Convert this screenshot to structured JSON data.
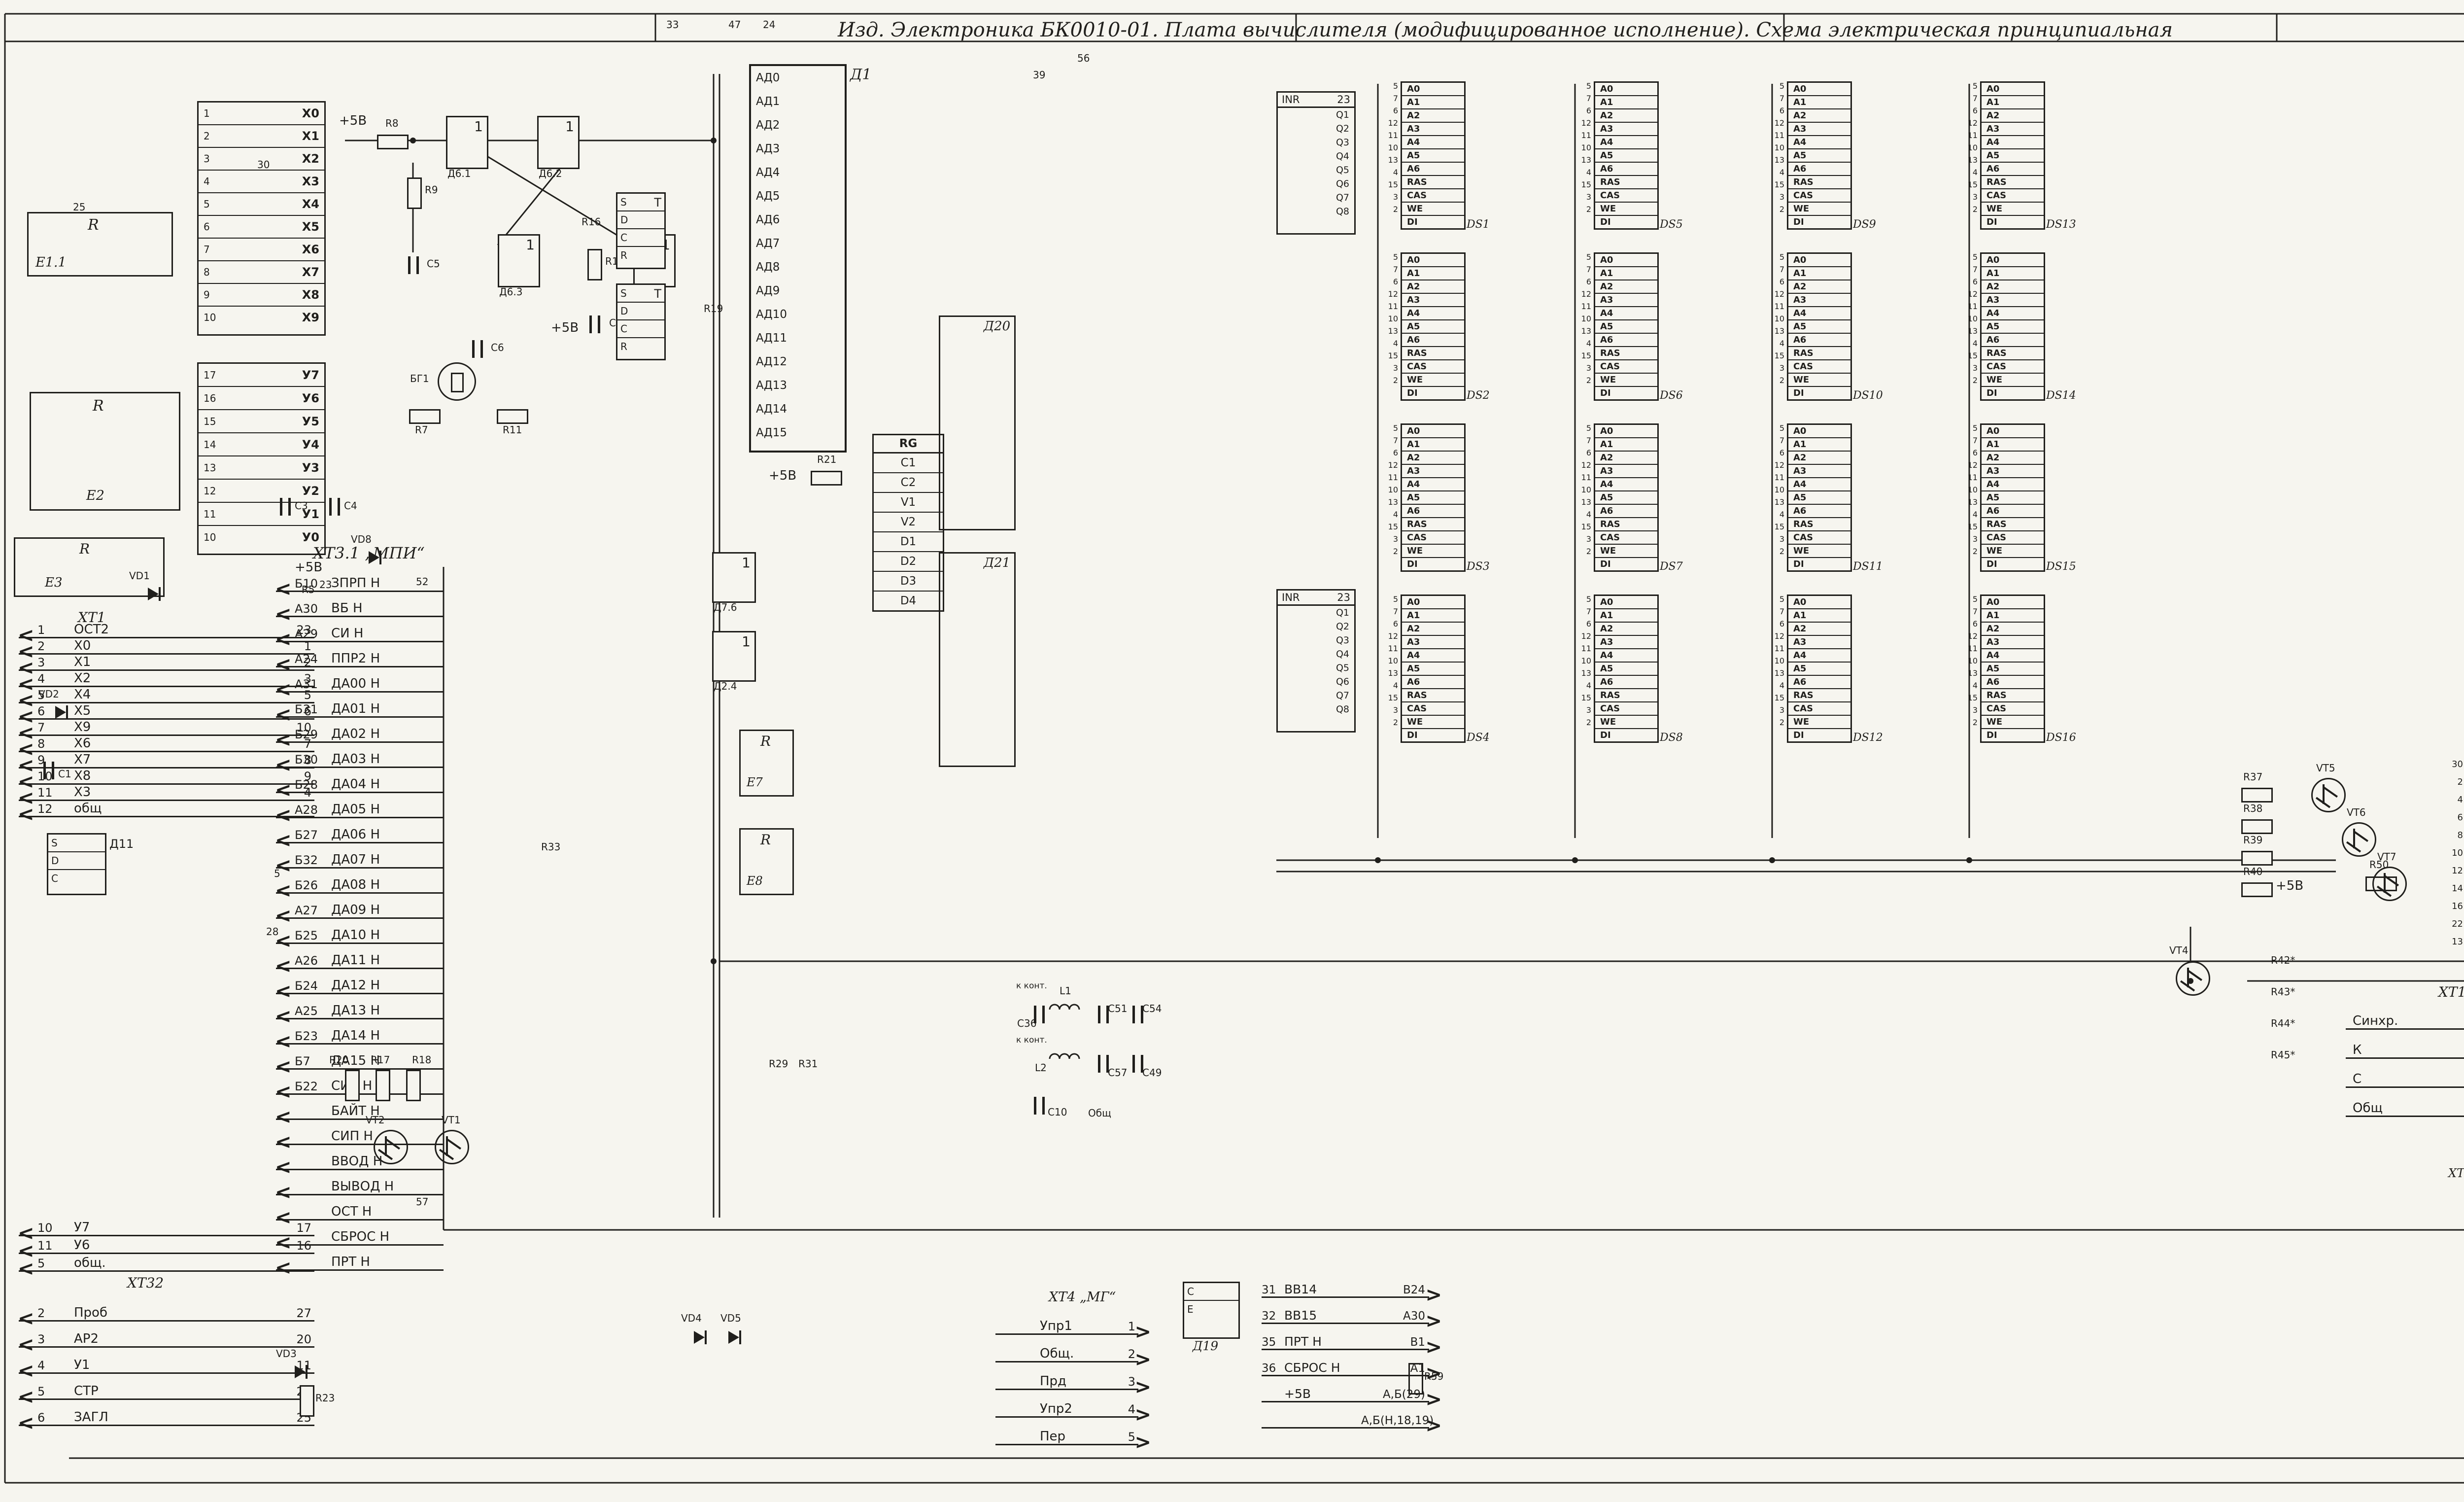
{
  "title": {
    "main": "Изд. Электроника  БК0010-01. Плата вычислителя (модифицированное исполнение). Схема  электрическая  принципиальная",
    "appendix": "Приложение"
  },
  "colors": {
    "ink": "#201f1c",
    "paper": "#f6f5ef"
  },
  "left": {
    "networks": [
      {
        "sym": "R",
        "name": "E1.1"
      },
      {
        "sym": "R",
        "name": "E2"
      },
      {
        "sym": "R",
        "name": "E3"
      }
    ],
    "xt1": {
      "name": "ХТ1",
      "rows": [
        {
          "pin": "1",
          "sig": "ОСТ2",
          "num": "23"
        },
        {
          "pin": "2",
          "sig": "Х0",
          "num": "1"
        },
        {
          "pin": "3",
          "sig": "Х1",
          "num": "2"
        },
        {
          "pin": "4",
          "sig": "Х2",
          "num": "3"
        },
        {
          "pin": "5",
          "sig": "Х4",
          "num": "5"
        },
        {
          "pin": "6",
          "sig": "Х5",
          "num": "6"
        },
        {
          "pin": "7",
          "sig": "Х9",
          "num": "10"
        },
        {
          "pin": "8",
          "sig": "Х6",
          "num": "7"
        },
        {
          "pin": "9",
          "sig": "Х7",
          "num": "8"
        },
        {
          "pin": "10",
          "sig": "Х8",
          "num": "9"
        },
        {
          "pin": "11",
          "sig": "Х3",
          "num": "4"
        },
        {
          "pin": "12",
          "sig": "общ",
          "num": ""
        }
      ]
    },
    "xt1b_rows": [
      {
        "pin": "10",
        "sig": "У7",
        "num": "17"
      },
      {
        "pin": "11",
        "sig": "У6",
        "num": "16"
      },
      {
        "pin": "5",
        "sig": "общ.",
        "num": ""
      }
    ],
    "xt32": {
      "name": "ХТ32",
      "rows": [
        {
          "pin": "2",
          "sig": "Проб",
          "num": "27"
        },
        {
          "pin": "3",
          "sig": "АР2",
          "num": "20"
        },
        {
          "pin": "4",
          "sig": "У1",
          "num": "11"
        },
        {
          "pin": "5",
          "sig": "СТР",
          "num": "26"
        },
        {
          "pin": "6",
          "sig": "ЗАГЛ",
          "num": "25"
        }
      ]
    },
    "d11": {
      "cells": [
        "S",
        "D",
        "C"
      ],
      "ds": "Д11"
    }
  },
  "keyboard": {
    "x_rows": [
      {
        "pin": "1",
        "sig": "Х0"
      },
      {
        "pin": "2",
        "sig": "Х1"
      },
      {
        "pin": "3",
        "sig": "Х2"
      },
      {
        "pin": "4",
        "sig": "Х3"
      },
      {
        "pin": "5",
        "sig": "Х4"
      },
      {
        "pin": "6",
        "sig": "Х5"
      },
      {
        "pin": "7",
        "sig": "Х6"
      },
      {
        "pin": "8",
        "sig": "Х7"
      },
      {
        "pin": "9",
        "sig": "Х8"
      },
      {
        "pin": "10",
        "sig": "Х9"
      }
    ],
    "y_rows": [
      {
        "pin": "17",
        "sig": "У7"
      },
      {
        "pin": "16",
        "sig": "У6"
      },
      {
        "pin": "15",
        "sig": "У5"
      },
      {
        "pin": "14",
        "sig": "У4"
      },
      {
        "pin": "13",
        "sig": "У3"
      },
      {
        "pin": "12",
        "sig": "У2"
      },
      {
        "pin": "11",
        "sig": "У1"
      },
      {
        "pin": "10",
        "sig": "У0"
      }
    ]
  },
  "cpu": {
    "ds": "Д1",
    "pins": [
      "АД0",
      "АД1",
      "АД2",
      "АД3",
      "АД4",
      "АД5",
      "АД6",
      "АД7",
      "АД8",
      "АД9",
      "АД10",
      "АД11",
      "АД12",
      "АД13",
      "АД14",
      "АД15"
    ]
  },
  "ff": {
    "t": "Т",
    "cells": [
      "S",
      "D",
      "C",
      "R"
    ]
  },
  "rg": {
    "title": "RG",
    "cells": [
      "C1",
      "C2",
      "V1",
      "V2",
      "D1",
      "D2",
      "D3",
      "D4"
    ]
  },
  "mpi": {
    "name": "ХТ3.1 „МПИ“",
    "rows": [
      {
        "pin": "Б10",
        "sig": "ЗПРП Н"
      },
      {
        "pin": "А30",
        "sig": "ВБ Н"
      },
      {
        "pin": "А29",
        "sig": "СИ Н"
      },
      {
        "pin": "А24",
        "sig": "ППР2 Н"
      },
      {
        "pin": "А31",
        "sig": "ДА00 Н"
      },
      {
        "pin": "Б31",
        "sig": "ДА01 Н"
      },
      {
        "pin": "Б29",
        "sig": "ДА02 Н"
      },
      {
        "pin": "Б30",
        "sig": "ДА03 Н"
      },
      {
        "pin": "Б28",
        "sig": "ДА04 Н"
      },
      {
        "pin": "А28",
        "sig": "ДА05 Н"
      },
      {
        "pin": "Б27",
        "sig": "ДА06 Н"
      },
      {
        "pin": "Б32",
        "sig": "ДА07 Н"
      },
      {
        "pin": "Б26",
        "sig": "ДА08 Н"
      },
      {
        "pin": "А27",
        "sig": "ДА09 Н"
      },
      {
        "pin": "Б25",
        "sig": "ДА10 Н"
      },
      {
        "pin": "А26",
        "sig": "ДА11 Н"
      },
      {
        "pin": "Б24",
        "sig": "ДА12 Н"
      },
      {
        "pin": "А25",
        "sig": "ДА13 Н"
      },
      {
        "pin": "Б23",
        "sig": "ДА14 Н"
      },
      {
        "pin": "Б7",
        "sig": "ДА15 Н"
      },
      {
        "pin": "Б22",
        "sig": "СИА Н"
      },
      {
        "pin": "",
        "sig": "БАЙТ Н"
      },
      {
        "pin": "",
        "sig": "СИП Н"
      },
      {
        "pin": "",
        "sig": "ВВОД Н"
      },
      {
        "pin": "",
        "sig": "ВЫВОД Н"
      },
      {
        "pin": "",
        "sig": "ОСТ Н"
      },
      {
        "pin": "",
        "sig": "СБРОС Н"
      },
      {
        "pin": "",
        "sig": "ПРТ Н"
      }
    ]
  },
  "mid": {
    "d20": "Д20",
    "d21": "Д21",
    "e7": "Е7",
    "e8": "Е8",
    "d19": {
      "cells": [
        "C",
        "E"
      ],
      "ds": "Д19"
    }
  },
  "ram": {
    "pin_labels": [
      "А0",
      "А1",
      "А2",
      "А3",
      "А4",
      "А5",
      "А6",
      "RAS",
      "CAS",
      "WE",
      "DI"
    ],
    "pin_nums": [
      "5",
      "7",
      "6",
      "12",
      "11",
      "10",
      "13",
      "4",
      "15",
      "3",
      "2"
    ],
    "chips": [
      {
        "ds": "DS1"
      },
      {
        "ds": "DS5"
      },
      {
        "ds": "DS9"
      },
      {
        "ds": "DS13"
      },
      {
        "ds": "DS2"
      },
      {
        "ds": "DS6"
      },
      {
        "ds": "DS10"
      },
      {
        "ds": "DS14"
      },
      {
        "ds": "DS3"
      },
      {
        "ds": "DS7"
      },
      {
        "ds": "DS11"
      },
      {
        "ds": "DS15"
      },
      {
        "ds": "DS4"
      },
      {
        "ds": "DS8"
      },
      {
        "ds": "DS12"
      },
      {
        "ds": "DS16"
      }
    ],
    "inr": {
      "label": "INR",
      "pin": "23",
      "outs": [
        "Q1",
        "Q2",
        "Q3",
        "Q4",
        "Q5",
        "Q6",
        "Q7",
        "Q8"
      ]
    }
  },
  "appendix": {
    "ctrl": [
      {
        "pin": "03",
        "sig": "SYNC"
      },
      {
        "pin": "01",
        "sig": "DIN"
      },
      {
        "pin": "23",
        "sig": "CE"
      },
      {
        "pin": "22",
        "sig": "WE"
      }
    ],
    "ad_rows": [
      {
        "sig": "AD0",
        "pin": "16",
        "out": "1"
      },
      {
        "sig": "AD1",
        "pin": "15",
        "out": "2"
      },
      {
        "sig": "AD2",
        "pin": "14",
        "out": "3"
      },
      {
        "sig": "AD3",
        "pin": "13",
        "out": "4"
      },
      {
        "sig": "AD4",
        "pin": "04",
        "out": "5"
      },
      {
        "sig": "AD5",
        "pin": "05",
        "out": "6"
      },
      {
        "sig": "AD6",
        "pin": "06",
        "out": "7"
      },
      {
        "sig": "AD7",
        "pin": "07",
        "out": "8"
      },
      {
        "sig": "AD8",
        "pin": "08",
        "out": "9"
      },
      {
        "sig": "AD9",
        "pin": "09",
        "out": "10"
      },
      {
        "sig": "AD10",
        "pin": "10",
        "out": "11"
      },
      {
        "sig": "AD11",
        "pin": "11",
        "out": "12"
      },
      {
        "sig": "AD12",
        "pin": "17",
        "out": "13"
      },
      {
        "sig": "AD13",
        "pin": "18",
        "out": "14"
      },
      {
        "sig": "AD14",
        "pin": "19",
        "out": "15"
      },
      {
        "sig": "AD15",
        "pin": "20",
        "out": "16"
      }
    ],
    "rply": {
      "sig": "RPLY",
      "pin": "02",
      "out": "32"
    },
    "chips": [
      {
        "ds": "DS17"
      },
      {
        "ds": "DS18"
      },
      {
        "ds": "DS19"
      },
      {
        "ds": "DS20"
      }
    ]
  },
  "video": {
    "d25": {
      "ds": "Д25",
      "rows": [
        {
          "n": "30",
          "sig": ""
        },
        {
          "n": "2",
          "sig": "D0"
        },
        {
          "n": "4",
          "sig": "D1"
        },
        {
          "n": "6",
          "sig": "D2"
        },
        {
          "n": "8",
          "sig": "D3"
        },
        {
          "n": "10",
          "sig": "D4"
        },
        {
          "n": "12",
          "sig": "D5"
        },
        {
          "n": "14",
          "sig": "D6"
        },
        {
          "n": "16",
          "sig": "D7"
        },
        {
          "n": "22",
          "sig": "C"
        },
        {
          "n": "13",
          "sig": "R"
        }
      ],
      "outs": [
        "Q1",
        "Q2",
        "Q3",
        "Q4",
        "Q5",
        "Q6",
        "Q7"
      ]
    },
    "ctv": {
      "name": "ХТ11 „ЦТВ“",
      "rows": [
        {
          "sig": "Синхр.",
          "pin": "1"
        },
        {
          "sig": "К",
          "pin": "3"
        },
        {
          "sig": "С",
          "pin": "5"
        },
        {
          "sig": "Общ",
          "pin": "2"
        }
      ]
    }
  },
  "mg": {
    "name": "ХТ4 „МГ“",
    "rows": [
      {
        "sig": "Упр1",
        "pin": "1"
      },
      {
        "sig": "Общ.",
        "pin": "2"
      },
      {
        "sig": "Прд",
        "pin": "3"
      },
      {
        "sig": "Упр2",
        "pin": "4"
      },
      {
        "sig": "Пер",
        "pin": "5"
      }
    ]
  },
  "buslist": {
    "rows": [
      {
        "n": "31",
        "sig": "ВВ14",
        "pin": "В24"
      },
      {
        "n": "32",
        "sig": "ВВ15",
        "pin": "А30"
      },
      {
        "n": "35",
        "sig": "ПРТ Н",
        "pin": "В1"
      },
      {
        "n": "36",
        "sig": "СБРОС Н",
        "pin": "А1"
      },
      {
        "n": "",
        "sig": "+5В",
        "pin": "А,Б(29)"
      },
      {
        "n": "",
        "sig": "",
        "pin": "А,Б(Н,18,19)"
      }
    ]
  },
  "tv": {
    "name": "ХТ9 „ТВ“",
    "pins": [
      "1",
      "3",
      "4",
      "5",
      "2"
    ]
  },
  "ptable": {
    "title": "Таблица разводки цепей пит.",
    "col_voltage": "Номинал напряже- ния",
    "col_device": "Устройство",
    "col_cont": "Конт.",
    "groups": [
      {
        "voltage": "+5В",
        "rows": [
          {
            "device": "D2, E1, E2, E4-E8",
            "cont": "1"
          },
          {
            "device": "DS1- DS16",
            "cont": "8,9"
          },
          {
            "device": "D1, D3, D6, D7, D9-D11, D13, D20, D21",
            "cont": "14"
          },
          {
            "device": "D12, D8, ХТ1, ХТ2",
            "cont": "16"
          },
          {
            "device": "D15-D18, D22-D25, DS17-DS20",
            "cont": "24"
          },
          {
            "device": "D4,    D19",
            "cont": "42"
          }
        ]
      },
      {
        "voltage": "Общий",
        "rows": [
          {
            "device": "E3",
            "cont": "1"
          },
          {
            "device": "D1, D3, D5-D7, D9-D11, D13, D20, D21",
            "cont": "7"
          },
          {
            "device": "D2, D8, D12, ХТ1, ХТ2",
            "cont": "8"
          },
          {
            "device": "D15-D18, D22-D25, DS17-DS20",
            "cont": "12"
          },
          {
            "device": "DS1- DS16",
            "cont": "16"
          },
          {
            "device": "D4, D14, D19",
            "cont": "21"
          }
        ]
      }
    ],
    "footnote": "*Подбирают при регулировании."
  },
  "parts": {
    "r5": "R5",
    "r7": "R7",
    "r8": "R8",
    "r9": "R9",
    "r11": "R11",
    "r14": "R14",
    "r16": "R16",
    "r17": "R17",
    "r18": "R18",
    "r19": "R19",
    "r20": "R20",
    "r21": "R21",
    "r23": "R23",
    "r29": "R29",
    "r31": "R31",
    "r33": "R33",
    "r37": "R37",
    "r38": "R38",
    "r39": "R39",
    "r40": "R40",
    "r42": "R42*",
    "r43": "R43*",
    "r44": "R44*",
    "r45": "R45*",
    "r50": "R50",
    "r55": "R55",
    "r56": "R56",
    "r57": "R57",
    "r58": "R58",
    "r59": "R59",
    "c1": "С1",
    "c3": "С3",
    "c4": "С4",
    "c5": "С5",
    "c6": "С6",
    "c7": "С7",
    "c10": "С10",
    "c36": "С36",
    "c49": "С49",
    "c51": "С51",
    "c52": "С52",
    "c54": "С54",
    "c57": "С57",
    "bq1": "БГ1",
    "p5v": "+5В",
    "obsh": "Общ",
    "kkont": "к конт.",
    "l1": "L1",
    "l2": "L2",
    "vd1": "VD1",
    "vd2": "VD2",
    "vd3": "VD3",
    "vd4": "VD4",
    "vd5": "VD5",
    "vd8": "VD8",
    "vt1": "VT1",
    "vt2": "VT2",
    "vt4": "VT4",
    "vt5": "VT5",
    "vt6": "VT6",
    "vt7": "VT7",
    "vt8": "VT8",
    "d61": "Д6.1",
    "d62": "Д6.2",
    "d63": "Д6.3",
    "d64": "Д6.4",
    "d76": "Д7.6",
    "d24": "Д2.4",
    "one": "1",
    "rlab": "R"
  },
  "wire_nums": {
    "n33": "33",
    "n47": "47",
    "n24": "24",
    "n56": "56",
    "n39": "39",
    "n30": "30",
    "n25": "25",
    "n5": "5",
    "n28": "28",
    "n23": "23",
    "n52": "52",
    "n17": "17",
    "n18": "18",
    "n53": "53",
    "n57": "57",
    "n12": "12"
  }
}
